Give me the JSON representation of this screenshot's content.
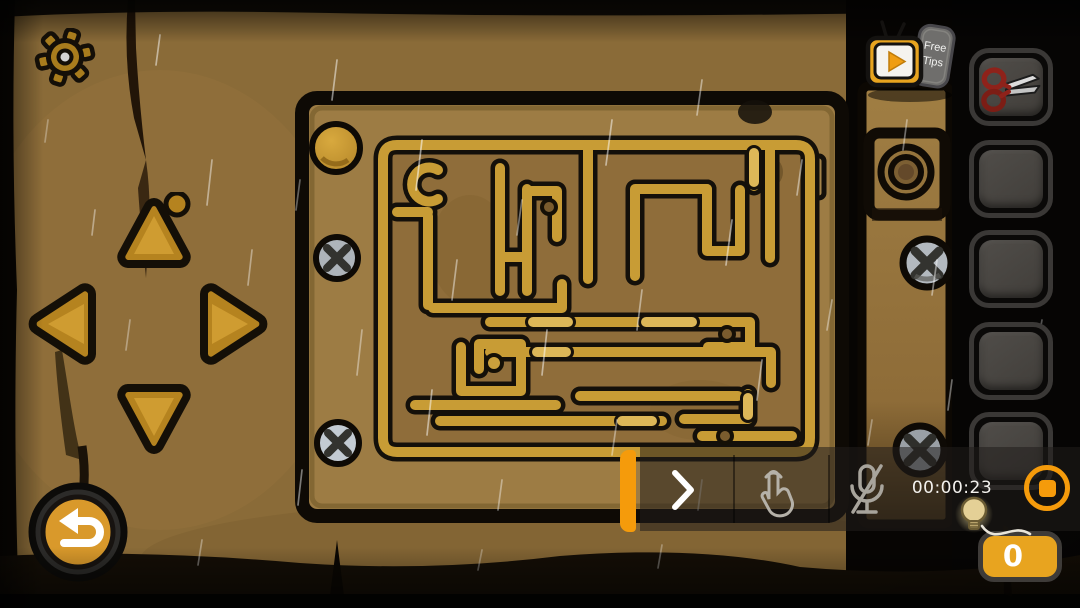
{
  "scene": {
    "name": "wooden-maze-puzzle-room",
    "weather": "rain",
    "colors": {
      "wall": "#8a6b38",
      "panel": "#9d7c44",
      "maze_track": "#c89c35",
      "maze_floor": "#8f6d3a"
    }
  },
  "topbar": {
    "settings_icon": "gear-icon",
    "free_tips": {
      "line1": "Free",
      "line2": "Tips",
      "icon": "tv-play-icon"
    }
  },
  "dpad": {
    "directions": [
      "up",
      "left",
      "right",
      "down"
    ]
  },
  "back_button": {
    "icon": "return-arrow-icon"
  },
  "inventory": {
    "slots": [
      {
        "index": 1,
        "item": "scissors"
      },
      {
        "index": 2,
        "item": ""
      },
      {
        "index": 3,
        "item": ""
      },
      {
        "index": 4,
        "item": ""
      },
      {
        "index": 5,
        "item": ""
      }
    ]
  },
  "recorder": {
    "timer": "00:00:23",
    "accent_color": "#F59B0B",
    "controls": [
      "expand-chevron",
      "touch-indicator",
      "microphone-muted",
      "timer",
      "stop-recording"
    ]
  },
  "hints": {
    "count": "0",
    "icon": "light-bulb-icon",
    "badge_color": "#E8A41F"
  }
}
